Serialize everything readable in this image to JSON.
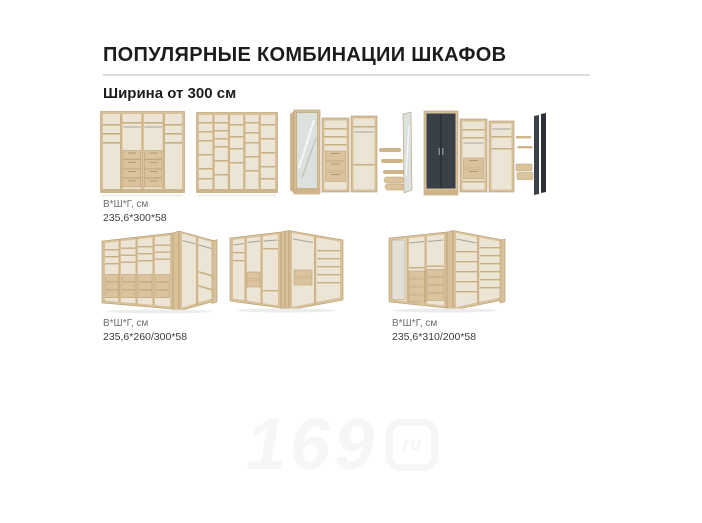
{
  "page": {
    "title": "ПОПУЛЯРНЫЕ КОМБИНАЦИИ ШКАФОВ",
    "subtitle": "Ширина от 300 см"
  },
  "groups": {
    "straight": {
      "dims_label": "В*Ш*Г, см",
      "dims_value": "235,6*300*58"
    },
    "corner_left": {
      "dims_label": "В*Ш*Г, см",
      "dims_value": "235,6*260/300*58"
    },
    "corner_right": {
      "dims_label": "В*Ш*Г, см",
      "dims_value": "235,6*310/200*58"
    }
  },
  "watermark": {
    "digits": "169",
    "suffix": "ru"
  },
  "icons": {
    "wardrobe_images": [
      "wardrobe-straight-shelves-drawers",
      "wardrobe-straight-open-shelving",
      "wardrobe-combo-mirror-door",
      "wardrobe-combo-dark-doors",
      "wardrobe-corner-drawers-left",
      "wardrobe-corner-v-shape",
      "wardrobe-corner-shelves-right"
    ]
  },
  "colors": {
    "wood": "#d8c099",
    "wood_dark": "#b49a6e",
    "dark_door": "#3a4048",
    "divider": "#dcdcdc",
    "title_text": "#1c1c1c",
    "label_gray": "#6e6e6e",
    "label_value": "#3e3e3e",
    "watermark": "#f6f6f6",
    "background": "#ffffff"
  }
}
